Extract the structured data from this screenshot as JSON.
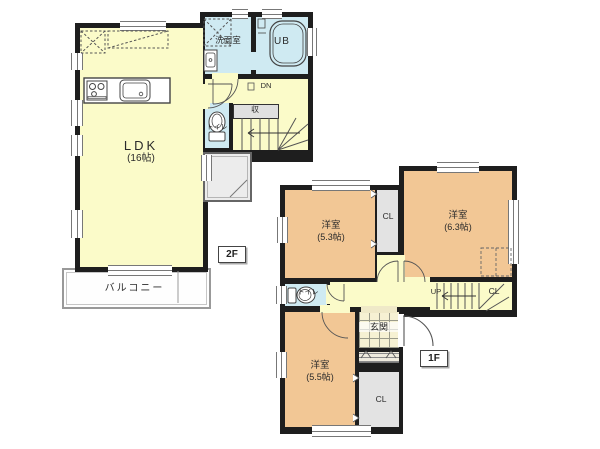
{
  "colors": {
    "wall": "#1e1e1e",
    "room_yellow": "#fbfbc9",
    "room_orange": "#f2c795",
    "room_blue": "#cfeaf2",
    "closet_gray": "#e3e3e3",
    "tile": "#f6f1d3"
  },
  "floor2": {
    "floor_label": "2F",
    "ldk_name": "LDK",
    "ldk_size": "(16帖)",
    "balcony": "バルコニー",
    "washroom": "洗面室",
    "bath": "UB",
    "toilet": "トイレ",
    "storage": "収",
    "stairs_direction": "DN"
  },
  "floor1": {
    "floor_label": "1F",
    "bedroom_a_name": "洋室",
    "bedroom_a_size": "(5.3帖)",
    "bedroom_b_name": "洋室",
    "bedroom_b_size": "(6.3帖)",
    "bedroom_c_name": "洋室",
    "bedroom_c_size": "(5.5帖)",
    "entrance": "玄関",
    "toilet": "トイレ",
    "closet_a": "CL",
    "closet_b": "CL",
    "closet_c": "CL",
    "stairs_direction": "UP"
  }
}
